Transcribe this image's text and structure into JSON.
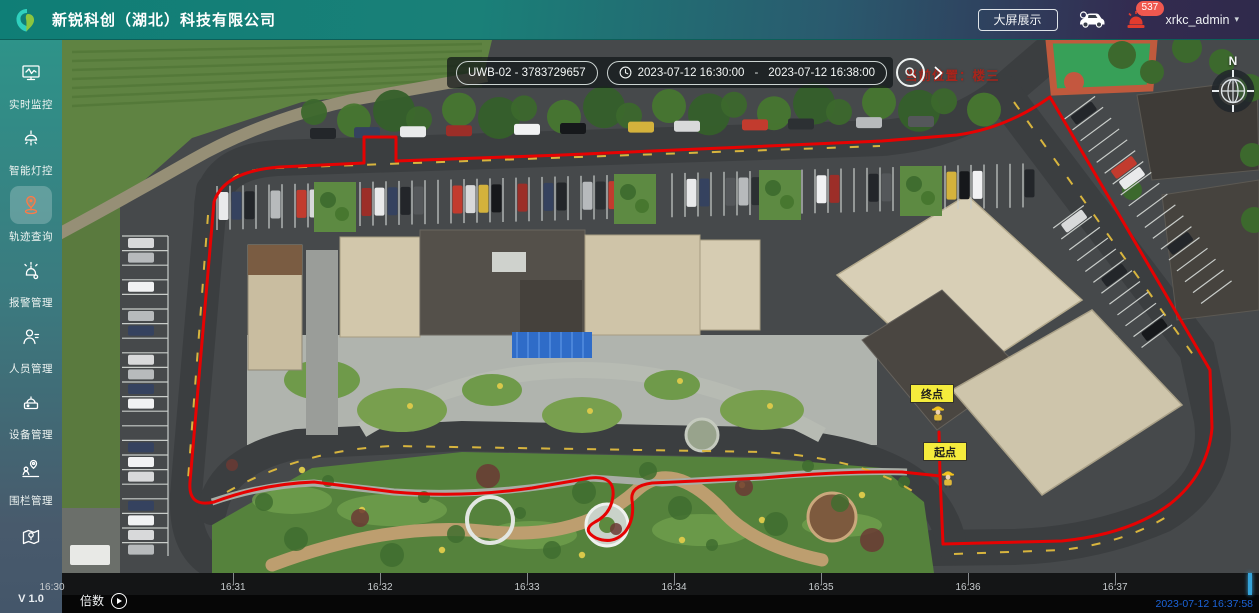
{
  "header": {
    "company_name": "新锐科创（湖北）科技有限公司",
    "big_screen_button": "大屏展示",
    "notification_count": "537",
    "username": "xrkc_admin",
    "user_caret": "▾"
  },
  "sidebar": {
    "items": [
      {
        "label": "实时监控",
        "icon": "monitor-icon"
      },
      {
        "label": "智能灯控",
        "icon": "smart-light-icon"
      },
      {
        "label": "轨迹查询",
        "icon": "trajectory-icon"
      },
      {
        "label": "报警管理",
        "icon": "alarm-bell-icon"
      },
      {
        "label": "人员管理",
        "icon": "person-icon"
      },
      {
        "label": "设备管理",
        "icon": "device-icon"
      },
      {
        "label": "围栏管理",
        "icon": "fence-pin-icon"
      },
      {
        "label": "",
        "icon": "map-icon"
      }
    ],
    "version": "V 1.0"
  },
  "map": {
    "toolbar": {
      "device_select": "UWB-02 - 3783729657",
      "time_start": "2023-07-12 16:30:00",
      "time_separator": "-",
      "time_end": "2023-07-12 16:38:00"
    },
    "current_location_text": "当前位置：楼三",
    "markers": {
      "end_label": "终点",
      "start_label": "起点"
    },
    "compass_north": "N"
  },
  "timeline": {
    "speed_label": "倍数",
    "ticks": [
      "16:30",
      "16:31",
      "16:32",
      "16:33",
      "16:34",
      "16:35",
      "16:36",
      "16:37"
    ],
    "current_time": "2023-07-12 16:37:58"
  },
  "colors": {
    "header_teal": "#0f7e76",
    "header_purple": "#322b50",
    "active_icon_orange": "#ff7a45",
    "alarm_red": "#e23b2e",
    "badge_red": "#f0584f",
    "path_red": "#e60202",
    "marker_yellow": "#f5ec3c",
    "playhead_cyan": "#35a3d9",
    "timestamp_blue": "#1c64d9"
  }
}
